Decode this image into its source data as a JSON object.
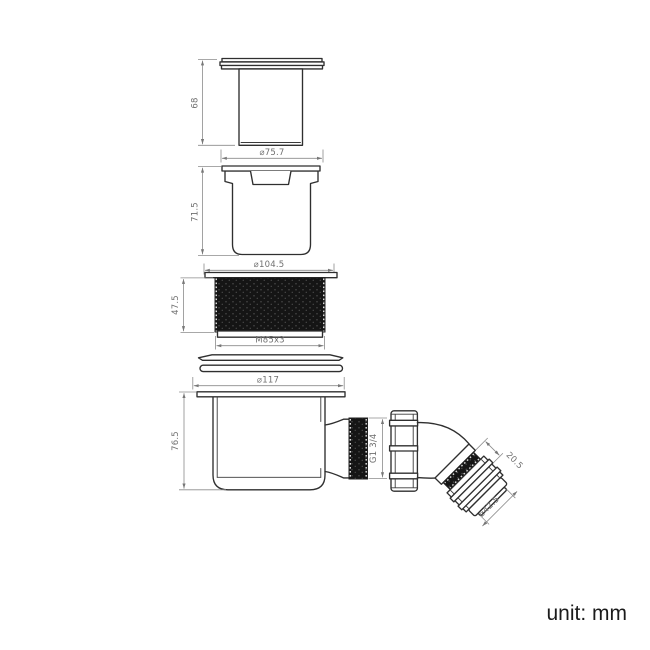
{
  "unit_note": "unit: mm",
  "drawing_type": "technical-drawing-shower-waste-trap",
  "colors": {
    "outline": "#2f2f2f",
    "dimension_line": "#8b8b8b",
    "dimension_text": "#6f6f6f",
    "thread_fill": "#151515",
    "note_text": "#1b1b1b",
    "background": "#ffffff"
  },
  "components": [
    {
      "name": "top-cap",
      "height": "68",
      "diameter": "⌀75.7"
    },
    {
      "name": "insert-body",
      "height": "71.5",
      "diameter": "⌀104.5"
    },
    {
      "name": "threaded-ring",
      "height": "47.5",
      "thread": "M85x3"
    },
    {
      "name": "sealing-washers",
      "count": "2"
    },
    {
      "name": "trap-body",
      "height": "76.5",
      "flange_diameter": "⌀117",
      "outlet_thread": "G1 3/4"
    },
    {
      "name": "outlet-elbow",
      "nut_length": "20.5",
      "outlet_diameter": "⌀42.5"
    }
  ],
  "dims": {
    "cap_height": "68",
    "cap_diameter": "⌀75.7",
    "insert_height": "71.5",
    "insert_diameter": "⌀104.5",
    "ring_height": "47.5",
    "ring_thread": "M85x3",
    "flange_diameter": "⌀117",
    "trap_height": "76.5",
    "outlet_thread": "G1 3/4",
    "elbow_nut_length": "20.5",
    "elbow_outlet_diameter": "⌀42.5"
  }
}
